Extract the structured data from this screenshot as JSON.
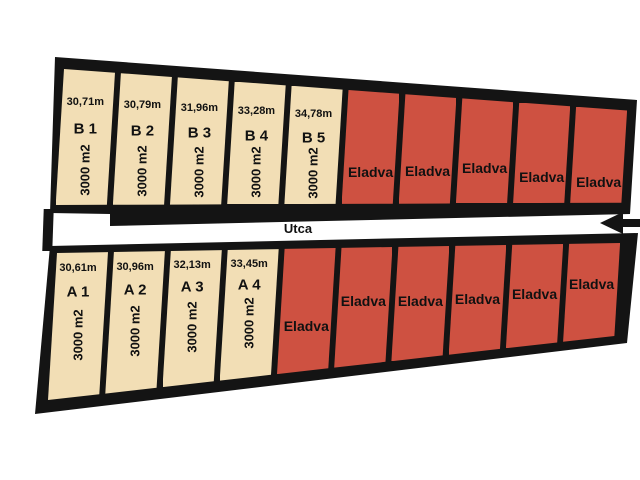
{
  "street": {
    "label": "Utca",
    "arrow_direction": "left"
  },
  "colors": {
    "available": "#F2DEB5",
    "sold": "#CE5141",
    "outline": "#141414",
    "background": "#FFFFFF",
    "text": "#111111"
  },
  "rows": {
    "top": [
      {
        "id": "B1",
        "label": "B 1",
        "frontage": "30,71m",
        "area": "3000 m2",
        "status": "available"
      },
      {
        "id": "B2",
        "label": "B 2",
        "frontage": "30,79m",
        "area": "3000 m2",
        "status": "available"
      },
      {
        "id": "B3",
        "label": "B 3",
        "frontage": "31,96m",
        "area": "3000 m2",
        "status": "available"
      },
      {
        "id": "B4",
        "label": "B 4",
        "frontage": "33,28m",
        "area": "3000 m2",
        "status": "available"
      },
      {
        "id": "B5",
        "label": "B 5",
        "frontage": "34,78m",
        "area": "3000 m2",
        "status": "available"
      },
      {
        "label": "Eladva",
        "status": "sold"
      },
      {
        "label": "Eladva",
        "status": "sold"
      },
      {
        "label": "Eladva",
        "status": "sold"
      },
      {
        "label": "Eladva",
        "status": "sold"
      },
      {
        "label": "Eladva",
        "status": "sold"
      }
    ],
    "bottom": [
      {
        "id": "A1",
        "label": "A 1",
        "frontage": "30,61m",
        "area": "3000 m2",
        "status": "available"
      },
      {
        "id": "A2",
        "label": "A 2",
        "frontage": "30,96m",
        "area": "3000 m2",
        "status": "available"
      },
      {
        "id": "A3",
        "label": "A 3",
        "frontage": "32,13m",
        "area": "3000 m2",
        "status": "available"
      },
      {
        "id": "A4",
        "label": "A 4",
        "frontage": "33,45m",
        "area": "3000 m2",
        "status": "available"
      },
      {
        "label": "Eladva",
        "status": "sold"
      },
      {
        "label": "Eladva",
        "status": "sold"
      },
      {
        "label": "Eladva",
        "status": "sold"
      },
      {
        "label": "Eladva",
        "status": "sold"
      },
      {
        "label": "Eladva",
        "status": "sold"
      },
      {
        "label": "Eladva",
        "status": "sold"
      }
    ]
  }
}
